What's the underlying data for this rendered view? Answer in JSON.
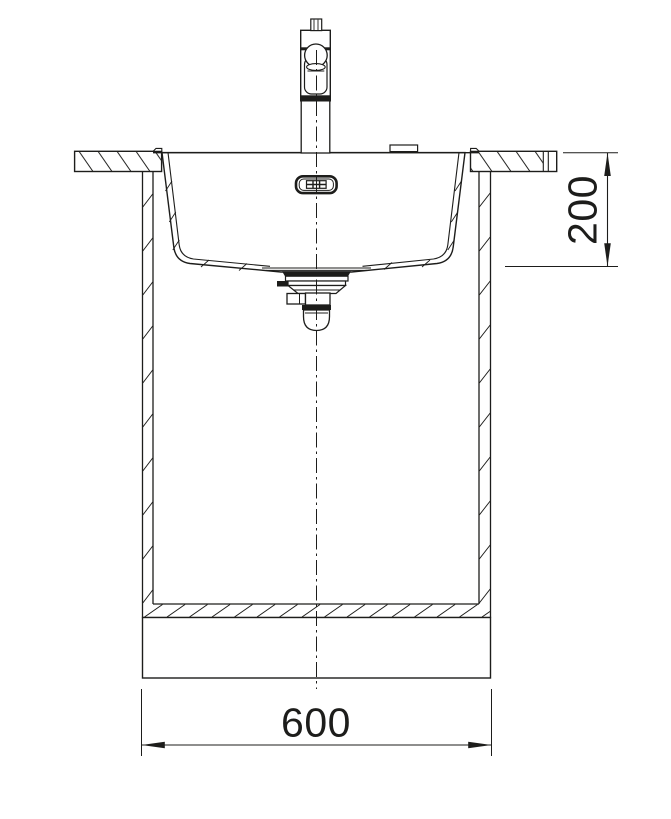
{
  "drawing": {
    "subject": "kitchen sink installation cross-section",
    "background_color": "#ffffff",
    "line_color": "#1d1d1b"
  },
  "dimensions": {
    "bowl_depth": {
      "label": "200",
      "orientation": "vertical"
    },
    "cabinet_width": {
      "label": "600",
      "orientation": "horizontal"
    }
  },
  "components": [
    "mixer-tap",
    "tap-hole-cover",
    "countertop-left",
    "countertop-right",
    "flush-mount-sink-bowl",
    "overflow-outlet",
    "drain-waste-assembly",
    "base-cabinet-walls",
    "cabinet-bottom-shelf",
    "plinth",
    "vertical-centerline"
  ]
}
